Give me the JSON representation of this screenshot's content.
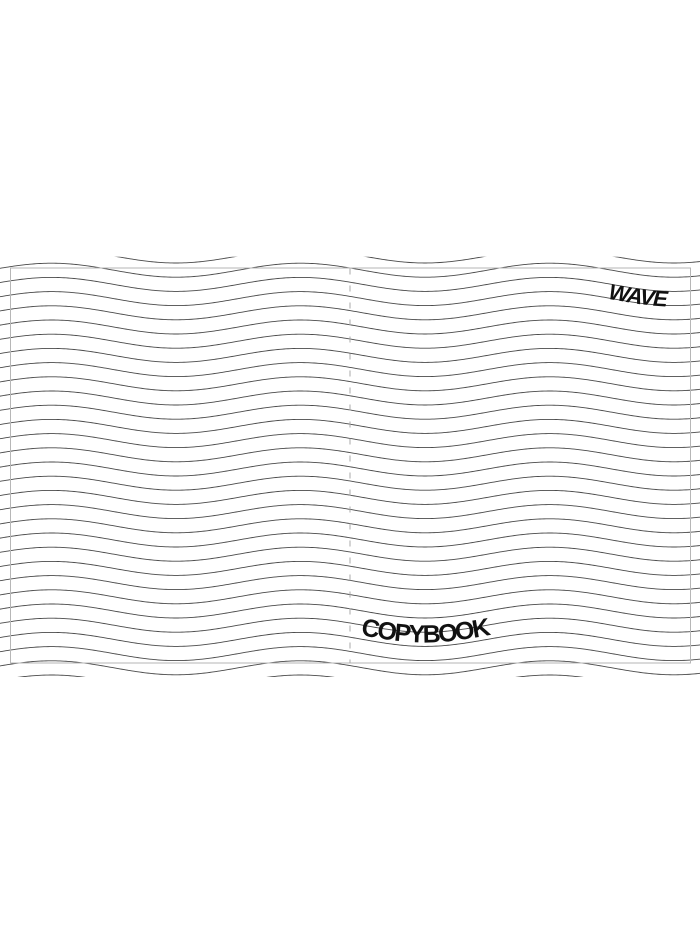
{
  "cover": {
    "brand": "WAVE",
    "title": "COPYBOOK"
  },
  "colors": {
    "background": "#ffffff",
    "wave_line": "#4a4a4a",
    "trim_frame": "#b6b6b6",
    "fold_line": "#a8a8a8",
    "text": "#111111"
  },
  "pattern": {
    "wave_count": 31,
    "wave_spacing": 14.2,
    "first_centerline_y": 256.0,
    "amplitude": 7,
    "period": 249,
    "phase_x": 113.75,
    "clip_top": 256.8,
    "clip_bottom": 677,
    "brand_baseline_y": 299.5,
    "brand_start_offset": 23,
    "title_baseline_y": 635.5,
    "frame": {
      "x": 10.5,
      "y": 268,
      "width": 680,
      "height": 395
    },
    "fold_x": 350,
    "fold_top": 268.5,
    "fold_bottom": 663,
    "fold_dash": "6 11"
  }
}
